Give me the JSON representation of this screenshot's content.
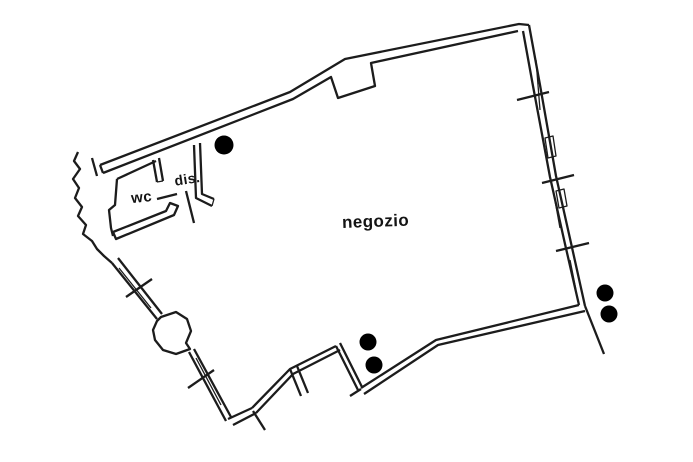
{
  "plan": {
    "labels": {
      "shop": "negozio",
      "wc": "wc",
      "hallway": "dis."
    },
    "colors": {
      "line": "#1c1c1c",
      "background": "#ffffff",
      "marker": "#000000"
    },
    "markers": {
      "column_dot_count": 5
    }
  }
}
